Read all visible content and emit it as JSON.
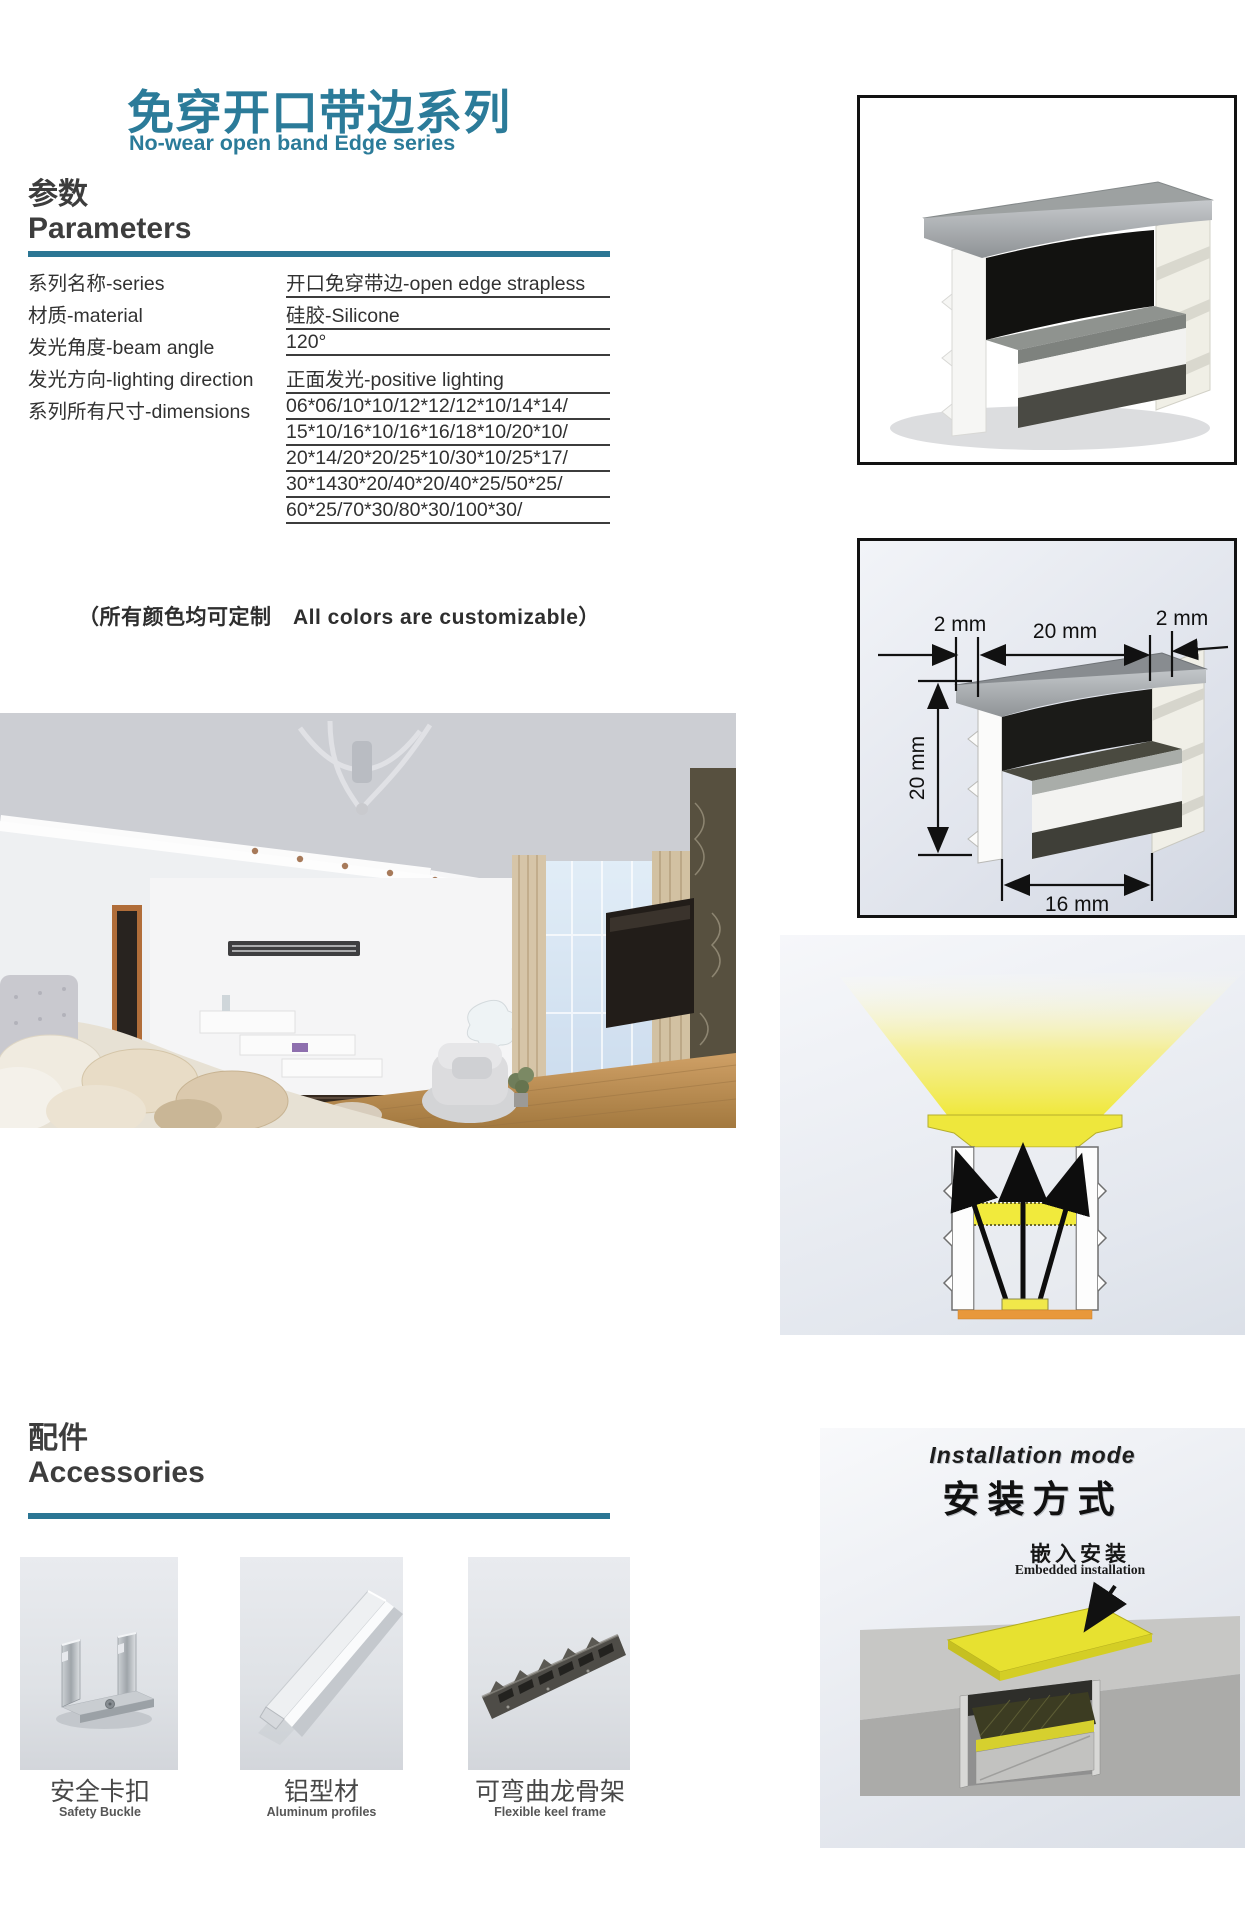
{
  "header": {
    "title_cn": "免穿开口带边系列",
    "title_en": "No-wear open band Edge series"
  },
  "parameters": {
    "heading_cn": "参数",
    "heading_en": "Parameters",
    "rows": [
      {
        "label": "系列名称-series",
        "value": "开口免穿带边-open edge strapless"
      },
      {
        "label": "材质-material",
        "value": "硅胶-Silicone"
      },
      {
        "label": "发光角度-beam angle",
        "value": "120°"
      },
      {
        "label": "发光方向-lighting direction",
        "value": "正面发光-positive lighting"
      }
    ],
    "dimensions_label": "系列所有尺寸-dimensions",
    "dimensions_lines": [
      "06*06/10*10/12*12/12*10/14*14/",
      "15*10/16*10/16*16/18*10/20*10/",
      "20*14/20*20/25*10/30*10/25*17/",
      "30*1430*20/40*20/40*25/50*25/",
      "60*25/70*30/80*30/100*30/"
    ],
    "note": "（所有颜色均可定制　All colors are customizable）"
  },
  "dimension_diagram": {
    "top_left": "2 mm",
    "top_center": "20 mm",
    "top_right": "2 mm",
    "side": "20 mm",
    "bottom": "16 mm"
  },
  "accessories": {
    "heading_cn": "配件",
    "heading_en": "Accessories",
    "items": [
      {
        "name_cn": "安全卡扣",
        "name_en": "Safety Buckle",
        "icon": "safety-buckle-photo"
      },
      {
        "name_cn": "铝型材",
        "name_en": "Aluminum profiles",
        "icon": "aluminum-profile-photo"
      },
      {
        "name_cn": "可弯曲龙骨架",
        "name_en": "Flexible keel frame",
        "icon": "flexible-keel-photo"
      }
    ]
  },
  "installation": {
    "heading_en": "Installation mode",
    "heading_cn": "安装方式",
    "method_cn": "嵌入安装",
    "method_en": "Embedded installation"
  },
  "colors": {
    "accent_teal": "#2b7b99",
    "bar_teal": "#2b7694",
    "strip_yellow": "#efe83b",
    "pcb_orange": "#e8983b",
    "text_dark": "#3d3d3d"
  }
}
